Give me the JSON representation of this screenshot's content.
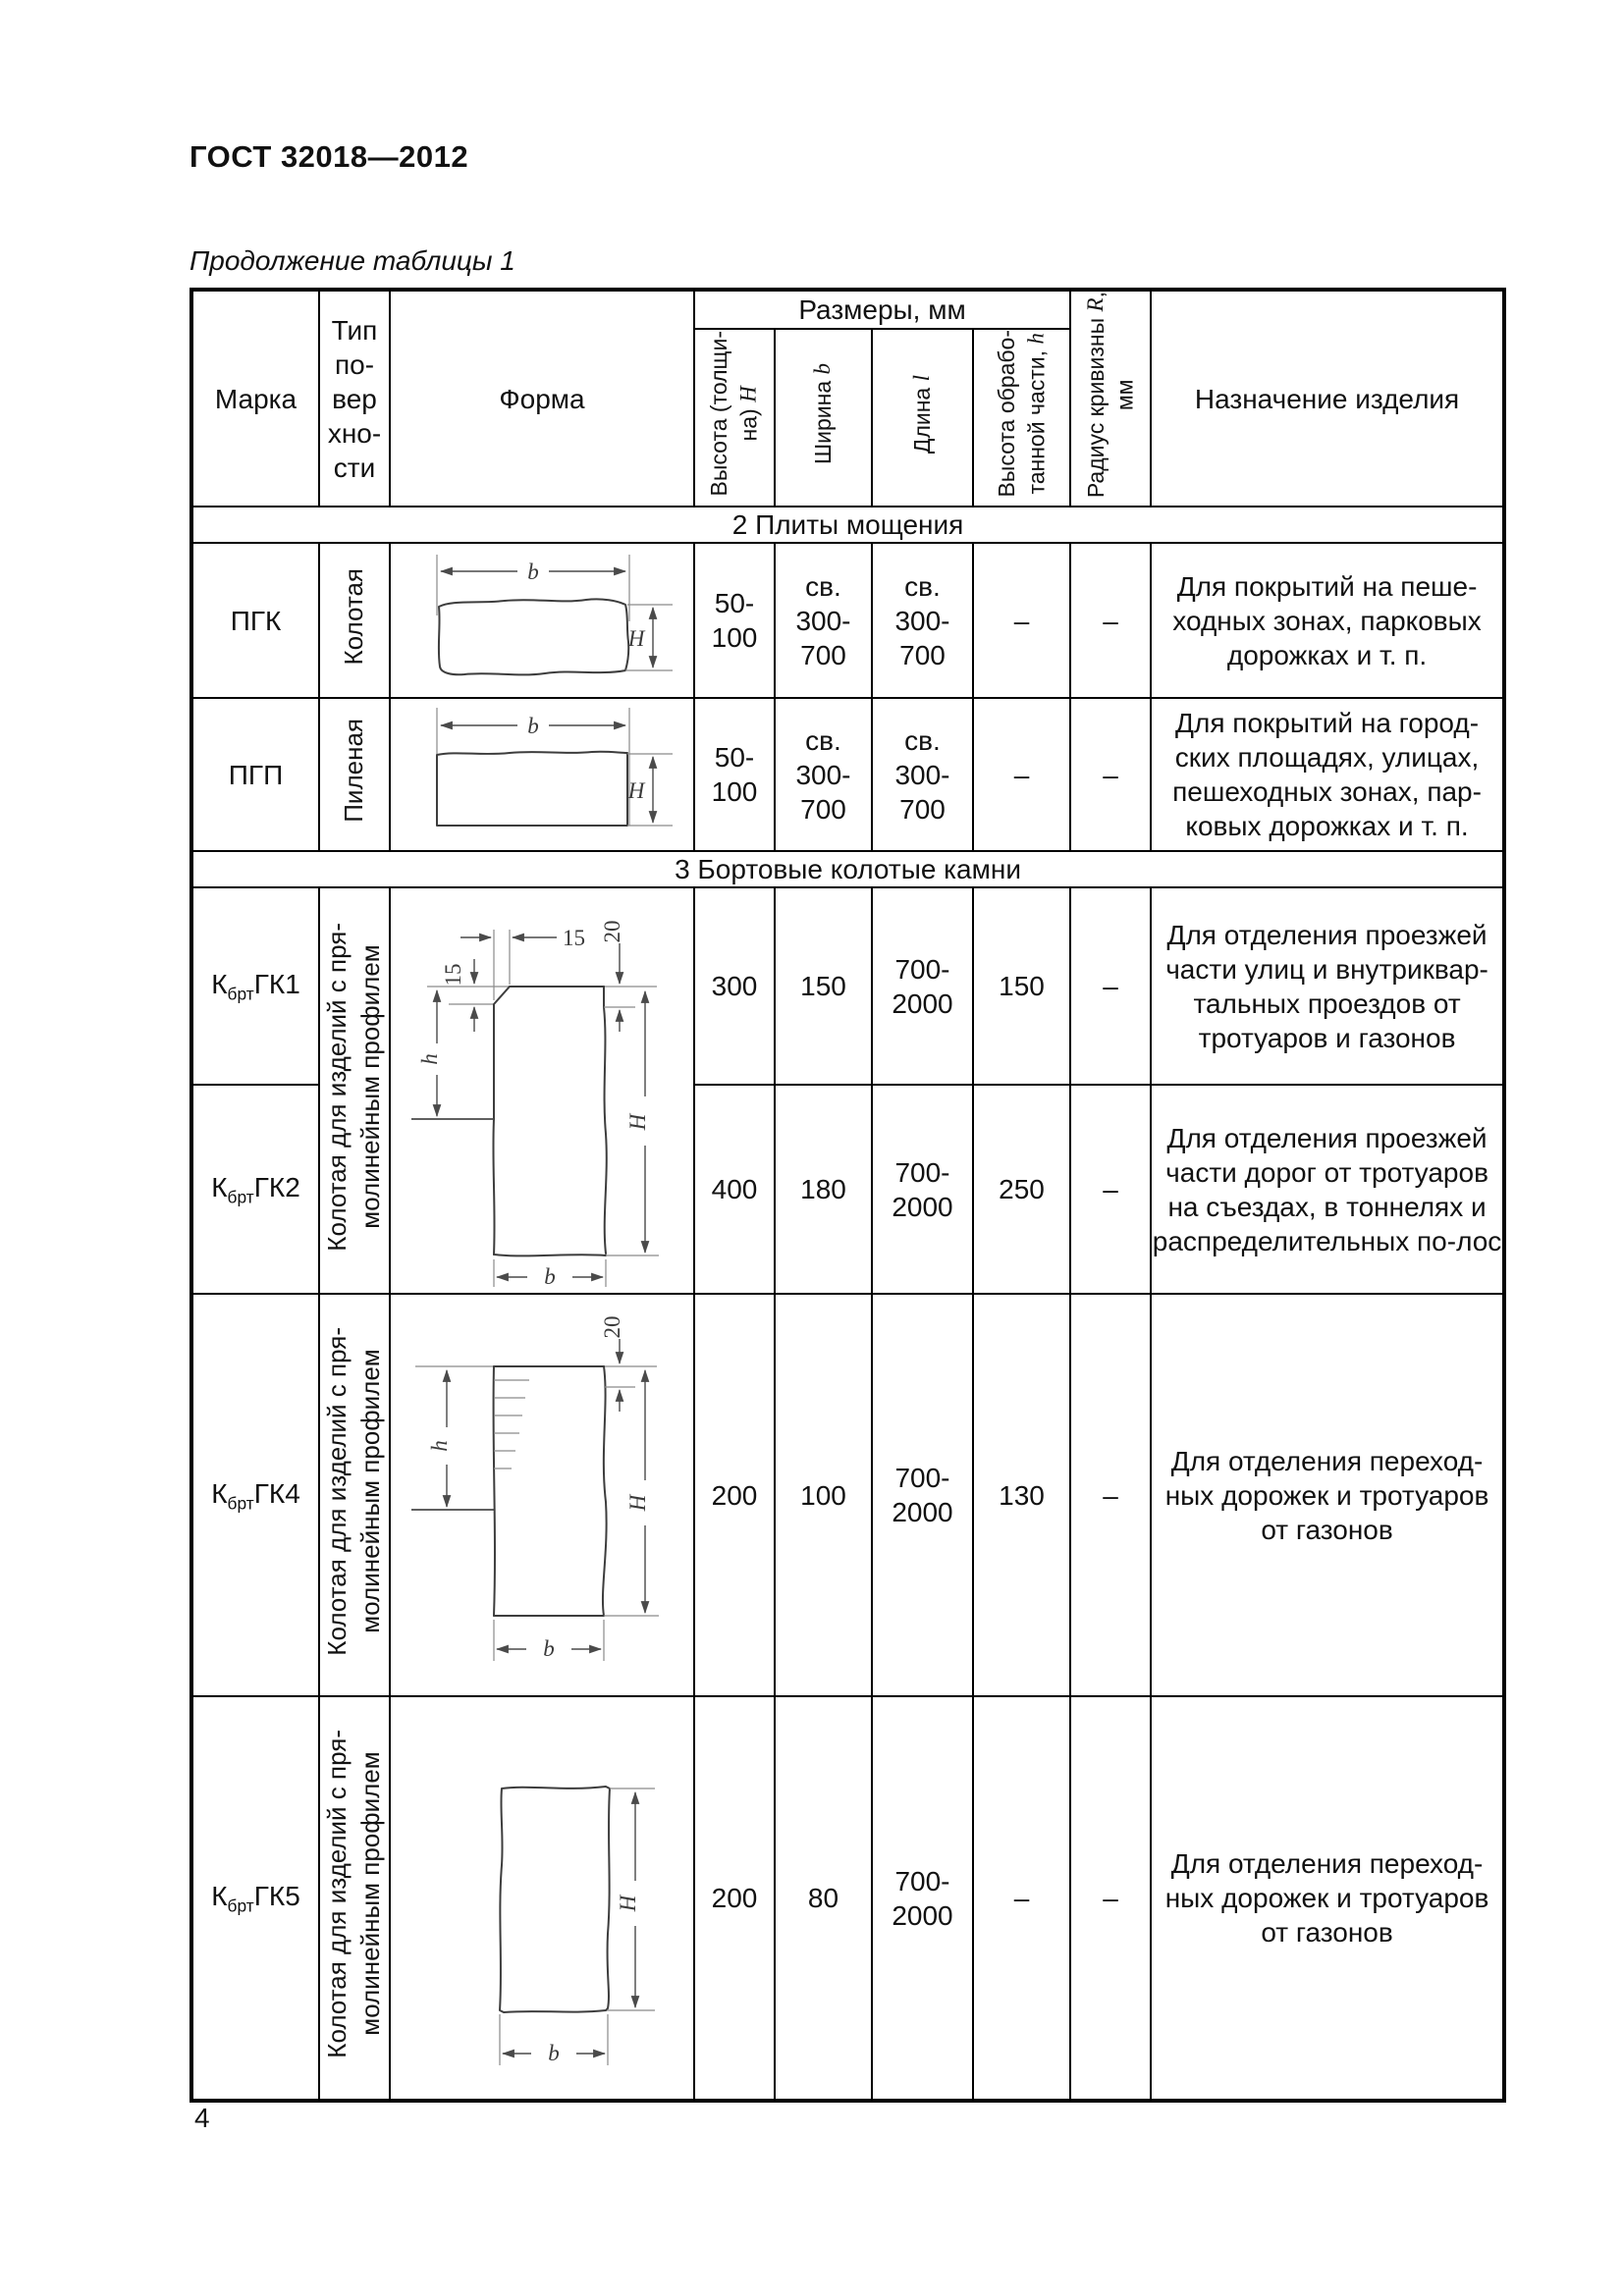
{
  "page": {
    "standard_number": "ГОСТ 32018—2012",
    "table_caption": "Продолжение таблицы 1",
    "page_number": "4"
  },
  "table": {
    "header": {
      "mark": "Марка",
      "surface_type": "Тип\nпо-\nвер\nхно-\nсти",
      "form": "Форма",
      "dimensions_group": "Размеры, мм",
      "height": {
        "label": "Высота (толщи-\nна) ",
        "symbol": "H"
      },
      "width": {
        "label": "Ширина ",
        "symbol": "b"
      },
      "length": {
        "label": "Длина ",
        "symbol": "l"
      },
      "worked_height": {
        "label": "Высота обрабо-\nтанной части, ",
        "symbol": "h"
      },
      "radius": {
        "label": "Радиус кривизны ",
        "symbol": "R",
        "suffix": ",\nмм"
      },
      "purpose": "Назначение изделия"
    },
    "sections": {
      "paving_slabs": "2 Плиты мощения",
      "curb_stones": "3 Бортовые колотые камни"
    },
    "rows": {
      "pgk": {
        "mark": "ПГК",
        "surface": "Колотая",
        "height": "50-\n100",
        "width": "св.\n300-\n700",
        "length": "св.\n300-\n700",
        "worked_height": "–",
        "radius": "–",
        "purpose": "Для покрытий на пеше-ходных зонах, парковых дорожках и т. п."
      },
      "pgp": {
        "mark": "ПГП",
        "surface": "Пиленая",
        "height": "50-\n100",
        "width": "св.\n300-\n700",
        "length": "св.\n300-\n700",
        "worked_height": "–",
        "radius": "–",
        "purpose": "Для покрытий на город-ских площадях, улицах, пешеходных зонах, пар-ковых дорожках и т. п."
      },
      "gk1": {
        "mark": {
          "pre": "К",
          "sub": "брт",
          "post": "ГК1"
        },
        "surface": "Колотая для изделий с пря-\nмолинейным профилем",
        "height": "300",
        "width": "150",
        "length": "700-\n2000",
        "worked_height": "150",
        "radius": "–",
        "purpose": "Для отделения проезжей части улиц и внутриквар-тальных проездов от тротуаров и газонов"
      },
      "gk2": {
        "mark": {
          "pre": "К",
          "sub": "брт",
          "post": "ГК2"
        },
        "height": "400",
        "width": "180",
        "length": "700-\n2000",
        "worked_height": "250",
        "radius": "–",
        "purpose": "Для отделения проезжей части дорог от тротуаров на съездах, в тоннелях и распределительных по-лос"
      },
      "gk4": {
        "mark": {
          "pre": "К",
          "sub": "брт",
          "post": "ГК4"
        },
        "surface": "Колотая для изделий с пря-\nмолинейным профилем",
        "height": "200",
        "width": "100",
        "length": "700-\n2000",
        "worked_height": "130",
        "radius": "–",
        "purpose": "Для отделения переход-ных дорожек и тротуаров от газонов"
      },
      "gk5": {
        "mark": {
          "pre": "К",
          "sub": "брт",
          "post": "ГК5"
        },
        "surface": "Колотая для изделий с пря-\nмолинейным профилем",
        "height": "200",
        "width": "80",
        "length": "700-\n2000",
        "worked_height": "–",
        "radius": "–",
        "purpose": "Для отделения переход-ных дорожек и тротуаров от газонов"
      }
    },
    "diagram_labels": {
      "b": "b",
      "H": "H",
      "h": "h",
      "n15": "15",
      "n20": "20"
    }
  },
  "colors": {
    "text": "#111111",
    "border": "#000000",
    "drawing_stroke": "#3d3d3d"
  }
}
